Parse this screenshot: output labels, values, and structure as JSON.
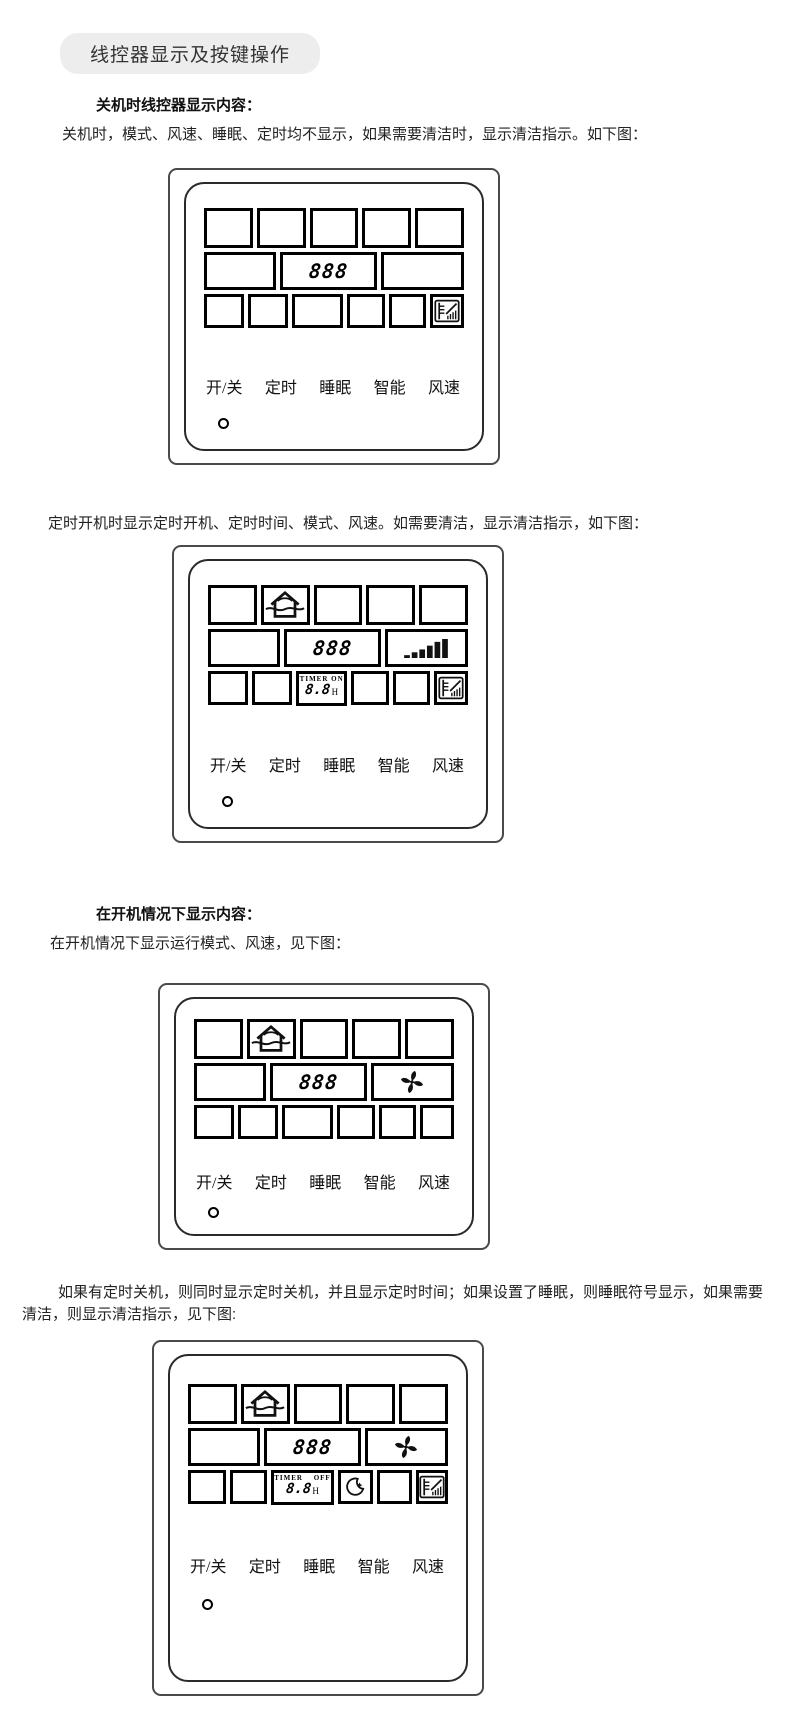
{
  "texts": {
    "title": "线控器显示及按键操作",
    "s1_heading": "关机时线控器显示内容：",
    "s1_text": "关机时，模式、风速、睡眠、定时均不显示，如果需要清洁时，显示清洁指示。如下图：",
    "s2_text": "定时开机时显示定时开机、定时时间、模式、风速。如需要清洁，显示清洁指示，如下图：",
    "s3_heading": "在开机情况下显示内容：",
    "s3_text": "在开机情况下显示运行模式、风速，见下图：",
    "s4_text": "如果有定时关机，则同时显示定时关机，并且显示定时时间；如果设置了睡眠，则睡眠符号显示，如果需要清洁，则显示清洁指示，见下图:"
  },
  "controller": {
    "temp_digits": "888",
    "timer_on_label": "TIMER ON",
    "timer_off_label": "TIMER OFF",
    "timer_digits": "8.8",
    "timer_unit": "H",
    "buttons": [
      "开/关",
      "定时",
      "睡眠",
      "智能",
      "风速"
    ]
  },
  "icons": {
    "mode": "house-airflow-icon",
    "fan_speed_bars": "fan-speed-wedge-bars-icon",
    "fan": "fan-pinwheel-icon",
    "sleep": "crescent-moon-icon",
    "clean": "clean-filter-icon"
  },
  "colors": {
    "banner_bg": "#ededed",
    "line": "#000000",
    "text": "#222222"
  }
}
